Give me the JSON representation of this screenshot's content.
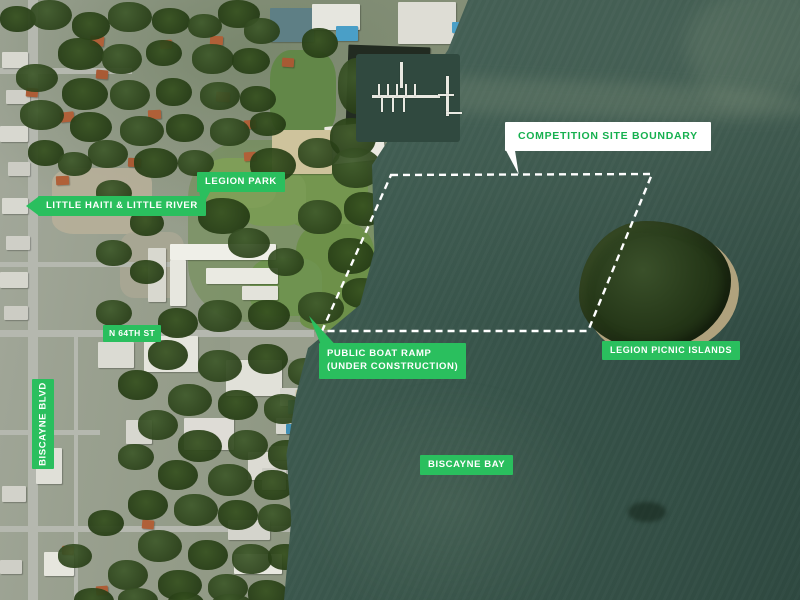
{
  "map": {
    "type": "satellite-annotated",
    "area": "Legion Park / Biscayne Bay waterfront"
  },
  "labels": {
    "competition_site_boundary": {
      "text": "COMPETITION SITE BOUNDARY"
    },
    "legion_park": {
      "text": "LEGION PARK"
    },
    "little_haiti_little_river": {
      "text": "LITTLE HAITI & LITTLE RIVER"
    },
    "n_64th_st": {
      "text": "N 64TH ST"
    },
    "public_boat_ramp": {
      "line1": "PUBLIC BOAT RAMP",
      "line2": "(UNDER CONSTRUCTION)"
    },
    "biscayne_blvd": {
      "text": "BISCAYNE BLVD"
    },
    "legion_picnic_islands": {
      "text": "LEGION PICNIC ISLANDS"
    },
    "biscayne_bay": {
      "text": "BISCAYNE BAY"
    }
  },
  "boundary": {
    "style": "dashed",
    "color": "#ffffff"
  },
  "colors": {
    "label_green": "#2abf5e",
    "label_text": "#ffffff",
    "boundary_label_bg": "#ffffff",
    "boundary_label_text": "#16b04f",
    "water_deep": "#2e4840",
    "water_light": "#4a675c"
  }
}
